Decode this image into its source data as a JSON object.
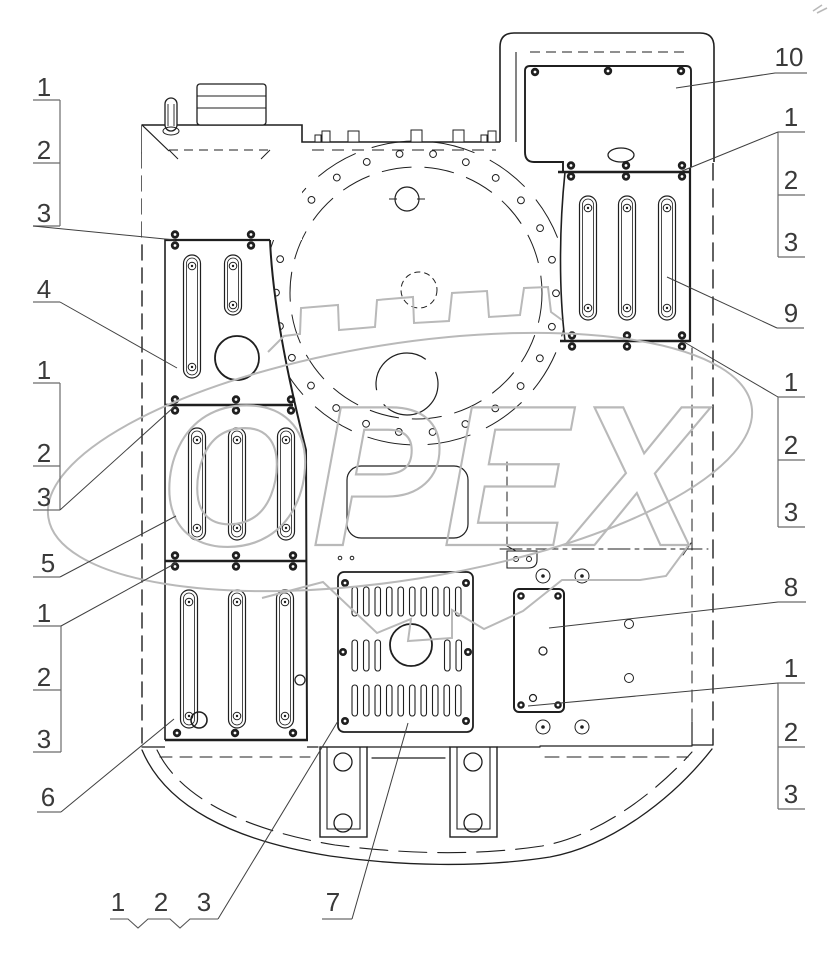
{
  "page": {
    "background": "#ffffff"
  },
  "drawing": {
    "watermark_text": "OPEX",
    "watermark_color": "#b9b9b9",
    "line_color": "#1f1f1f",
    "callout_color": "#3a3a3a"
  },
  "callouts": [
    {
      "name": "left-group-top",
      "labels": [
        {
          "text": "1",
          "x": 44,
          "y": 96
        },
        {
          "text": "2",
          "x": 44,
          "y": 159
        },
        {
          "text": "3",
          "x": 44,
          "y": 222
        }
      ],
      "lines": [
        [
          33,
          100,
          60,
          100
        ],
        [
          33,
          163,
          60,
          163
        ],
        [
          33,
          226,
          60,
          226
        ],
        [
          60,
          100,
          60,
          226
        ]
      ],
      "leader": [
        [
          33,
          226
        ],
        [
          175,
          240
        ]
      ]
    },
    {
      "name": "callout-4",
      "labels": [
        {
          "text": "4",
          "x": 44,
          "y": 298
        }
      ],
      "lines": [
        [
          33,
          302,
          60,
          302
        ]
      ],
      "leader": [
        [
          60,
          302
        ],
        [
          177,
          368
        ]
      ]
    },
    {
      "name": "left-group-mid",
      "labels": [
        {
          "text": "1",
          "x": 44,
          "y": 379
        },
        {
          "text": "2",
          "x": 44,
          "y": 462
        },
        {
          "text": "3",
          "x": 44,
          "y": 506
        }
      ],
      "lines": [
        [
          33,
          383,
          60,
          383
        ],
        [
          33,
          466,
          60,
          466
        ],
        [
          33,
          510,
          60,
          510
        ],
        [
          60,
          383,
          60,
          510
        ]
      ],
      "leader": [
        [
          60,
          510
        ],
        [
          175,
          406
        ]
      ]
    },
    {
      "name": "callout-5",
      "labels": [
        {
          "text": "5",
          "x": 48,
          "y": 572
        }
      ],
      "lines": [
        [
          33,
          577,
          60,
          577
        ]
      ],
      "leader": [
        [
          60,
          577
        ],
        [
          176,
          516
        ]
      ]
    },
    {
      "name": "left-group-bottom",
      "labels": [
        {
          "text": "1",
          "x": 44,
          "y": 622
        },
        {
          "text": "2",
          "x": 44,
          "y": 686
        },
        {
          "text": "3",
          "x": 44,
          "y": 748
        }
      ],
      "lines": [
        [
          33,
          626,
          61,
          626
        ],
        [
          33,
          690,
          61,
          690
        ],
        [
          33,
          752,
          61,
          752
        ],
        [
          61,
          626,
          61,
          752
        ]
      ],
      "leader": [
        [
          61,
          626
        ],
        [
          176,
          563
        ]
      ]
    },
    {
      "name": "callout-6",
      "labels": [
        {
          "text": "6",
          "x": 48,
          "y": 806
        }
      ],
      "lines": [
        [
          37,
          812,
          61,
          812
        ]
      ],
      "leader": [
        [
          61,
          812
        ],
        [
          174,
          719
        ]
      ]
    },
    {
      "name": "bottom-group",
      "labels": [
        {
          "text": "1",
          "x": 118,
          "y": 911
        },
        {
          "text": "2",
          "x": 161,
          "y": 911
        },
        {
          "text": "3",
          "x": 204,
          "y": 911
        }
      ],
      "polylines": [
        [
          [
            110,
            919
          ],
          [
            128,
            919
          ],
          [
            138,
            928
          ],
          [
            148,
            919
          ],
          [
            170,
            919
          ],
          [
            180,
            928
          ],
          [
            190,
            919
          ],
          [
            218,
            919
          ]
        ]
      ],
      "leader": [
        [
          218,
          919
        ],
        [
          338,
          721
        ]
      ]
    },
    {
      "name": "callout-7",
      "labels": [
        {
          "text": "7",
          "x": 333,
          "y": 911
        }
      ],
      "lines": [
        [
          322,
          919,
          352,
          919
        ]
      ],
      "leader": [
        [
          352,
          919
        ],
        [
          408,
          723
        ]
      ]
    },
    {
      "name": "callout-10",
      "labels": [
        {
          "text": "10",
          "x": 789,
          "y": 66
        }
      ],
      "lines": [
        [
          775,
          73,
          807,
          73
        ]
      ],
      "leader": [
        [
          775,
          73
        ],
        [
          676,
          88
        ]
      ]
    },
    {
      "name": "right-group-top",
      "labels": [
        {
          "text": "1",
          "x": 791,
          "y": 126
        },
        {
          "text": "2",
          "x": 791,
          "y": 189
        },
        {
          "text": "3",
          "x": 791,
          "y": 251
        }
      ],
      "lines": [
        [
          778,
          132,
          805,
          132
        ],
        [
          778,
          195,
          805,
          195
        ],
        [
          778,
          257,
          805,
          257
        ],
        [
          778,
          132,
          778,
          257
        ]
      ],
      "leader": [
        [
          778,
          132
        ],
        [
          682,
          171
        ]
      ]
    },
    {
      "name": "callout-9",
      "labels": [
        {
          "text": "9",
          "x": 791,
          "y": 322
        }
      ],
      "lines": [
        [
          777,
          328,
          804,
          328
        ]
      ],
      "leader": [
        [
          777,
          328
        ],
        [
          667,
          277
        ]
      ]
    },
    {
      "name": "right-group-mid",
      "labels": [
        {
          "text": "1",
          "x": 791,
          "y": 391
        },
        {
          "text": "2",
          "x": 791,
          "y": 454
        },
        {
          "text": "3",
          "x": 791,
          "y": 521
        }
      ],
      "lines": [
        [
          778,
          397,
          805,
          397
        ],
        [
          778,
          460,
          805,
          460
        ],
        [
          778,
          527,
          805,
          527
        ],
        [
          778,
          397,
          778,
          527
        ]
      ],
      "leader": [
        [
          778,
          397
        ],
        [
          684,
          342
        ]
      ]
    },
    {
      "name": "callout-8",
      "labels": [
        {
          "text": "8",
          "x": 791,
          "y": 596
        }
      ],
      "lines": [
        [
          778,
          602,
          806,
          602
        ]
      ],
      "leader": [
        [
          778,
          602
        ],
        [
          549,
          628
        ]
      ]
    },
    {
      "name": "right-group-bottom",
      "labels": [
        {
          "text": "1",
          "x": 791,
          "y": 677
        },
        {
          "text": "2",
          "x": 791,
          "y": 741
        },
        {
          "text": "3",
          "x": 791,
          "y": 803
        }
      ],
      "lines": [
        [
          778,
          683,
          805,
          683
        ],
        [
          778,
          747,
          805,
          747
        ],
        [
          778,
          809,
          805,
          809
        ],
        [
          778,
          683,
          778,
          809
        ]
      ],
      "leader": [
        [
          778,
          683
        ],
        [
          528,
          706
        ]
      ]
    }
  ]
}
